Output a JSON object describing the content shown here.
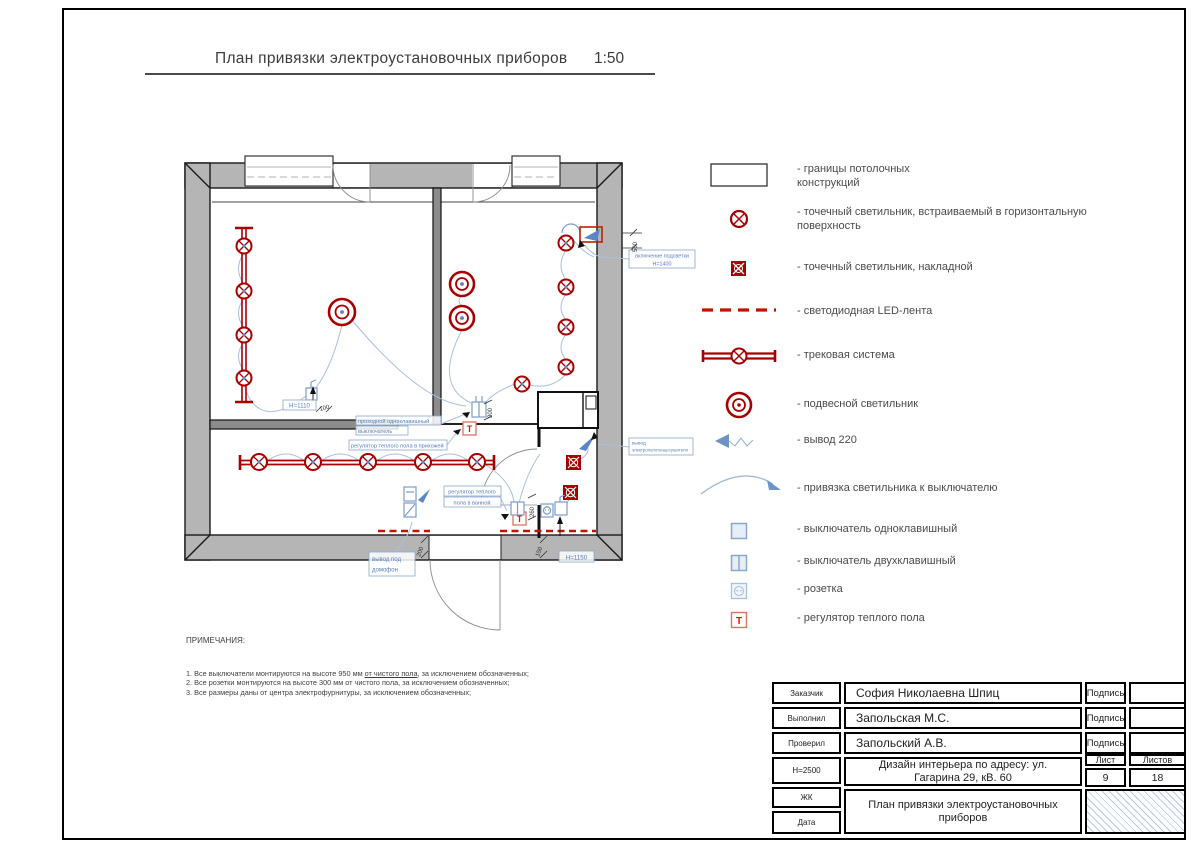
{
  "title": {
    "text": "План привязки электроустановочных приборов",
    "scale": "1:50"
  },
  "colors": {
    "symbol_red": "#a80000",
    "led_red": "#c41200",
    "device_blue": "#7d9cc9",
    "label_blue": "#5580bb",
    "wall_gray": "#b5b5b5"
  },
  "legend": {
    "items": [
      {
        "icon": "ceiling-boundary-icon",
        "label": "- границы потолочных конструкций"
      },
      {
        "icon": "recessed-spot-icon",
        "label": "- точечный светильник, встраиваемый в горизонтальную поверхность"
      },
      {
        "icon": "surface-spot-icon",
        "label": "- точечный светильник, накладной"
      },
      {
        "icon": "led-strip-icon",
        "label": "- светодиодная LED-лента"
      },
      {
        "icon": "track-system-icon",
        "label": "- трековая система"
      },
      {
        "icon": "pendant-light-icon",
        "label": "- подвесной светильник"
      },
      {
        "icon": "outlet-220-icon",
        "label": "- вывод 220"
      },
      {
        "icon": "binding-arc-icon",
        "label": "- привязка светильника к выключателю"
      },
      {
        "icon": "switch-single-icon",
        "label": "- выключатель одноклавишный"
      },
      {
        "icon": "switch-double-icon",
        "label": "- выключатель двухклавишный"
      },
      {
        "icon": "socket-icon",
        "label": "- розетка"
      },
      {
        "icon": "floor-heating-icon",
        "label": "- регулятор теплого пола"
      }
    ],
    "t_glyph": "Т"
  },
  "plan": {
    "labels": {
      "backlight_line1": "включение подсветки",
      "backlight_line2": "Н=1400",
      "pass_switch_line1": "проходной одноклавишный",
      "pass_switch_line2": "выключатель",
      "heat_hall": "регулятор теплого пола в прихожей",
      "heat_bath_line1": "регулятор теплого",
      "heat_bath_line2": "пола в ванной",
      "intercom_line1": "вывод под",
      "intercom_line2": "домофон",
      "towel_line1": "вывод",
      "towel_line2": "электрополотенцесушителя",
      "h_living": "H=1110",
      "h_bath": "H=1150"
    },
    "dimensions": {
      "living_switch": "100",
      "entry": "200",
      "bath_socket": "150",
      "bath_switch": "260",
      "bedroom_switch": "300",
      "backlight": "500"
    }
  },
  "notes": {
    "heading": "ПРИМЕЧАНИЯ:",
    "n1a": "1. Все выключатели монтируются на высоте 950 мм ",
    "n1b": "от чистого пола",
    "n1c": ", за исключением обозначенных;",
    "n2": "2. Все розетки монтируются на высоте 300 мм от чистого пола, за исключением обозначенных;",
    "n3": "3. Все размеры даны от центра электрофурнитуры, за исключением обозначенных;"
  },
  "titleblock": {
    "customer_label": "Заказчик",
    "customer": "София Николаевна Шпиц",
    "executor_label": "Выполнил",
    "executor": "Запольская М.С.",
    "checker_label": "Проверил",
    "checker": "Запольский А.В.",
    "signature": "Подпись",
    "height_label": "Н=2500",
    "complex_label": "ЖК",
    "date_label": "Дата",
    "project_line1": "Дизайн интерьера по адресу: ул.",
    "project_line2": "Гагарина 29, кВ. 60",
    "sheet_label": "Лист",
    "sheets_label": "Листов",
    "sheet_number": "9",
    "sheets_total": "18",
    "doc_title_line1": "План привязки электроустановочных",
    "doc_title_line2": "приборов"
  }
}
